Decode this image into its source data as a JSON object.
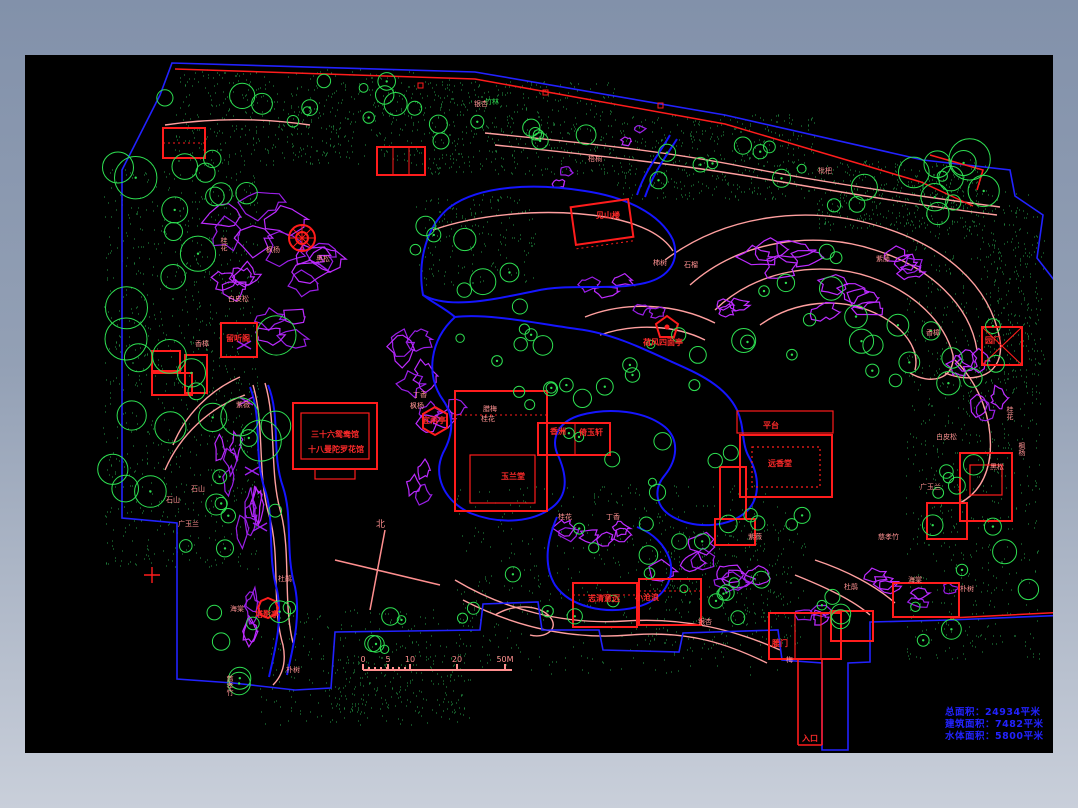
{
  "viewer": {
    "background_top": "#8291aa",
    "background_bottom": "#c9cfda",
    "canvas_color": "#000000"
  },
  "stats": {
    "line1": "总面积：24934平米",
    "line2": "建筑面积：7482平米",
    "line3": "水体面积：5800平米",
    "color": "#2222ff"
  },
  "compass": {
    "label": "北"
  },
  "scale_bar": {
    "unit": "M",
    "ticks": [
      {
        "label": "0",
        "x": 0
      },
      {
        "label": "5",
        "x": 25
      },
      {
        "label": "10",
        "x": 47
      },
      {
        "label": "20",
        "x": 94
      },
      {
        "label": "50M",
        "x": 142
      }
    ]
  },
  "palette": {
    "tree_green": "#2ee052",
    "speckle_green": "#1c7a38",
    "rockery_magenta": "#bd2bff",
    "contour_salmon": "#ff9f9f",
    "water_blue": "#1515ff",
    "building_red": "#ff1c1c",
    "boundary_blue": "#2222ff",
    "label_pink": "#ff9292",
    "stats_blue": "#2222ff"
  },
  "labels": {
    "buildings": [
      {
        "t": "见山楼",
        "x": 573,
        "y": 163
      },
      {
        "t": "荷风四面亭",
        "x": 620,
        "y": 290
      },
      {
        "t": "平台",
        "x": 740,
        "y": 373
      },
      {
        "t": "远香堂",
        "x": 745,
        "y": 411
      },
      {
        "t": "香洲",
        "x": 527,
        "y": 379
      },
      {
        "t": "倚玉轩",
        "x": 556,
        "y": 380
      },
      {
        "t": "玉兰堂",
        "x": 478,
        "y": 424
      },
      {
        "t": "三十六鸳鸯馆",
        "x": 288,
        "y": 382
      },
      {
        "t": "十八曼陀罗花馆",
        "x": 285,
        "y": 397
      },
      {
        "t": "留听阁",
        "x": 203,
        "y": 286
      },
      {
        "t": "宜两亭",
        "x": 399,
        "y": 368
      },
      {
        "t": "塔影亭",
        "x": 232,
        "y": 562
      },
      {
        "t": "志清意远",
        "x": 565,
        "y": 546
      },
      {
        "t": "小沧浪",
        "x": 612,
        "y": 545
      },
      {
        "t": "腰门",
        "x": 749,
        "y": 591
      },
      {
        "t": "园门",
        "x": 962,
        "y": 288
      },
      {
        "t": "入口",
        "x": 779,
        "y": 686
      }
    ],
    "plants": [
      {
        "t": "桂花",
        "x": 197,
        "y": 188,
        "v": true
      },
      {
        "t": "枫杨",
        "x": 243,
        "y": 198
      },
      {
        "t": "黑松",
        "x": 293,
        "y": 207
      },
      {
        "t": "白皮松",
        "x": 205,
        "y": 247
      },
      {
        "t": "香樟",
        "x": 172,
        "y": 292
      },
      {
        "t": "石山",
        "x": 168,
        "y": 437
      },
      {
        "t": "石山",
        "x": 143,
        "y": 448
      },
      {
        "t": "广玉兰",
        "x": 155,
        "y": 472
      },
      {
        "t": "紫薇",
        "x": 213,
        "y": 353
      },
      {
        "t": "杜鹃",
        "x": 255,
        "y": 527
      },
      {
        "t": "海棠",
        "x": 207,
        "y": 557
      },
      {
        "t": "慈孝竹",
        "x": 203,
        "y": 626,
        "v": true
      },
      {
        "t": "朴树",
        "x": 263,
        "y": 618
      },
      {
        "t": "丁香",
        "x": 390,
        "y": 343
      },
      {
        "t": "枫杨",
        "x": 387,
        "y": 354
      },
      {
        "t": "腊梅",
        "x": 460,
        "y": 357
      },
      {
        "t": "桂花",
        "x": 458,
        "y": 367
      },
      {
        "t": "银杏",
        "x": 451,
        "y": 52
      },
      {
        "t": "梧桐",
        "x": 565,
        "y": 107
      },
      {
        "t": "柿树",
        "x": 630,
        "y": 211
      },
      {
        "t": "石榴",
        "x": 661,
        "y": 213
      },
      {
        "t": "枇杷",
        "x": 795,
        "y": 119
      },
      {
        "t": "紫藤",
        "x": 853,
        "y": 207
      },
      {
        "t": "香樟",
        "x": 903,
        "y": 281
      },
      {
        "t": "桂花",
        "x": 983,
        "y": 357,
        "v": true
      },
      {
        "t": "枫杨",
        "x": 995,
        "y": 393,
        "v": true
      },
      {
        "t": "黑松",
        "x": 967,
        "y": 415
      },
      {
        "t": "白皮松",
        "x": 913,
        "y": 385
      },
      {
        "t": "广玉兰",
        "x": 897,
        "y": 435
      },
      {
        "t": "慈孝竹",
        "x": 855,
        "y": 485
      },
      {
        "t": "杜鹃",
        "x": 821,
        "y": 535
      },
      {
        "t": "海棠",
        "x": 885,
        "y": 528
      },
      {
        "t": "朴树",
        "x": 937,
        "y": 537
      },
      {
        "t": "紫薇",
        "x": 725,
        "y": 485
      },
      {
        "t": "丁香",
        "x": 583,
        "y": 465
      },
      {
        "t": "桂花",
        "x": 535,
        "y": 465
      },
      {
        "t": "银杏",
        "x": 675,
        "y": 570
      },
      {
        "t": "梅",
        "x": 763,
        "y": 608
      }
    ],
    "green_labels": [
      {
        "t": "竹林",
        "x": 462,
        "y": 50
      }
    ]
  }
}
